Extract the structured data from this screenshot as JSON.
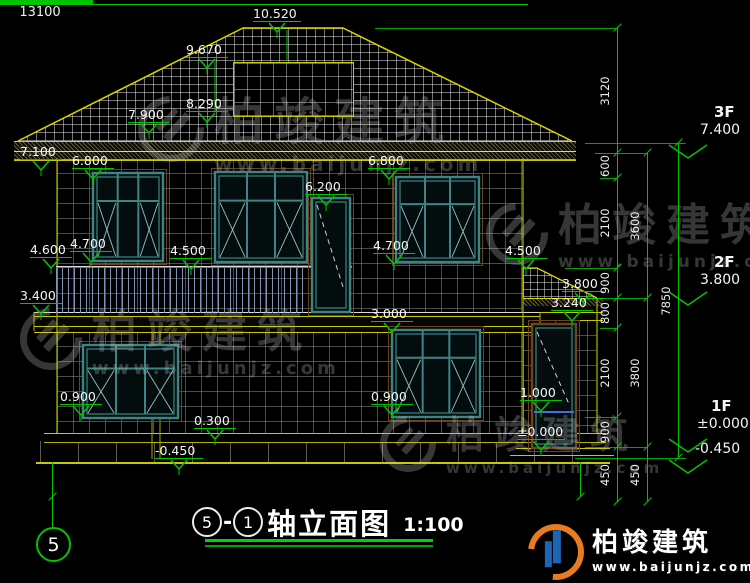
{
  "drawing_title": {
    "bubble_left": "5",
    "separator": "-",
    "bubble_right": "1",
    "name": "轴立面图",
    "scale": "1:100"
  },
  "axis_bubble": "5",
  "bottom_dim_total": "13100",
  "watermark": {
    "brand": "柏竣建筑",
    "url": "www.baijunjz.com"
  },
  "logo": {
    "brand": "柏竣建筑",
    "url": "www.baijunjz.com"
  },
  "elevations": [
    {
      "t": "10.520",
      "x": 253,
      "y": 6
    },
    {
      "t": "9.670",
      "x": 186,
      "y": 42
    },
    {
      "t": "8.290",
      "x": 186,
      "y": 96
    },
    {
      "t": "7.900",
      "x": 128,
      "y": 107
    },
    {
      "t": "7.100",
      "x": 20,
      "y": 144
    },
    {
      "t": "6.800",
      "x": 72,
      "y": 153
    },
    {
      "t": "6.800",
      "x": 368,
      "y": 153
    },
    {
      "t": "6.200",
      "x": 305,
      "y": 179
    },
    {
      "t": "4.600",
      "x": 30,
      "y": 242
    },
    {
      "t": "4.700",
      "x": 70,
      "y": 236
    },
    {
      "t": "4.500",
      "x": 170,
      "y": 243
    },
    {
      "t": "4.700",
      "x": 373,
      "y": 238
    },
    {
      "t": "4.500",
      "x": 505,
      "y": 243
    },
    {
      "t": "3.400",
      "x": 20,
      "y": 288
    },
    {
      "t": "3.000",
      "x": 371,
      "y": 306
    },
    {
      "t": "3.800",
      "x": 562,
      "y": 276
    },
    {
      "t": "3.240",
      "x": 551,
      "y": 295
    },
    {
      "t": "0.900",
      "x": 60,
      "y": 389
    },
    {
      "t": "0.900",
      "x": 371,
      "y": 389
    },
    {
      "t": "1.000",
      "x": 520,
      "y": 385
    },
    {
      "t": "0.300",
      "x": 194,
      "y": 413
    },
    {
      "t": "±0.000",
      "x": 517,
      "y": 424
    },
    {
      "t": "-0.450",
      "x": 155,
      "y": 443
    }
  ],
  "floor_markers": [
    {
      "floor": "3F",
      "value": "7.400",
      "x": 700,
      "y": 103,
      "line_y": 143
    },
    {
      "floor": "2F",
      "value": "3.800",
      "x": 700,
      "y": 253,
      "line_y": 290
    },
    {
      "floor": "1F",
      "value": "±0.000",
      "x": 697,
      "y": 397,
      "line_y": 437
    },
    {
      "floor": "",
      "value": "-0.450",
      "x": 695,
      "y": 441,
      "line_y": 458
    }
  ],
  "dim_chains": [
    {
      "x": 617,
      "segments": [
        {
          "v": "3120",
          "y1": 28,
          "y2": 153
        },
        {
          "v": "600",
          "y1": 153,
          "y2": 178
        },
        {
          "v": "2100",
          "y1": 178,
          "y2": 268
        },
        {
          "v": "900",
          "y1": 268,
          "y2": 298
        },
        {
          "v": "800",
          "y1": 298,
          "y2": 328
        },
        {
          "v": "2100",
          "y1": 328,
          "y2": 417
        },
        {
          "v": "900",
          "y1": 417,
          "y2": 447
        },
        {
          "v": "450",
          "y1": 447,
          "y2": 502
        }
      ]
    },
    {
      "x": 647,
      "segments": [
        {
          "v": "3600",
          "y1": 153,
          "y2": 298
        },
        {
          "v": "3800",
          "y1": 298,
          "y2": 447
        },
        {
          "v": "450",
          "y1": 447,
          "y2": 502
        }
      ]
    },
    {
      "x": 678,
      "segments": [
        {
          "v": "7850",
          "y1": 143,
          "y2": 458
        }
      ]
    }
  ]
}
